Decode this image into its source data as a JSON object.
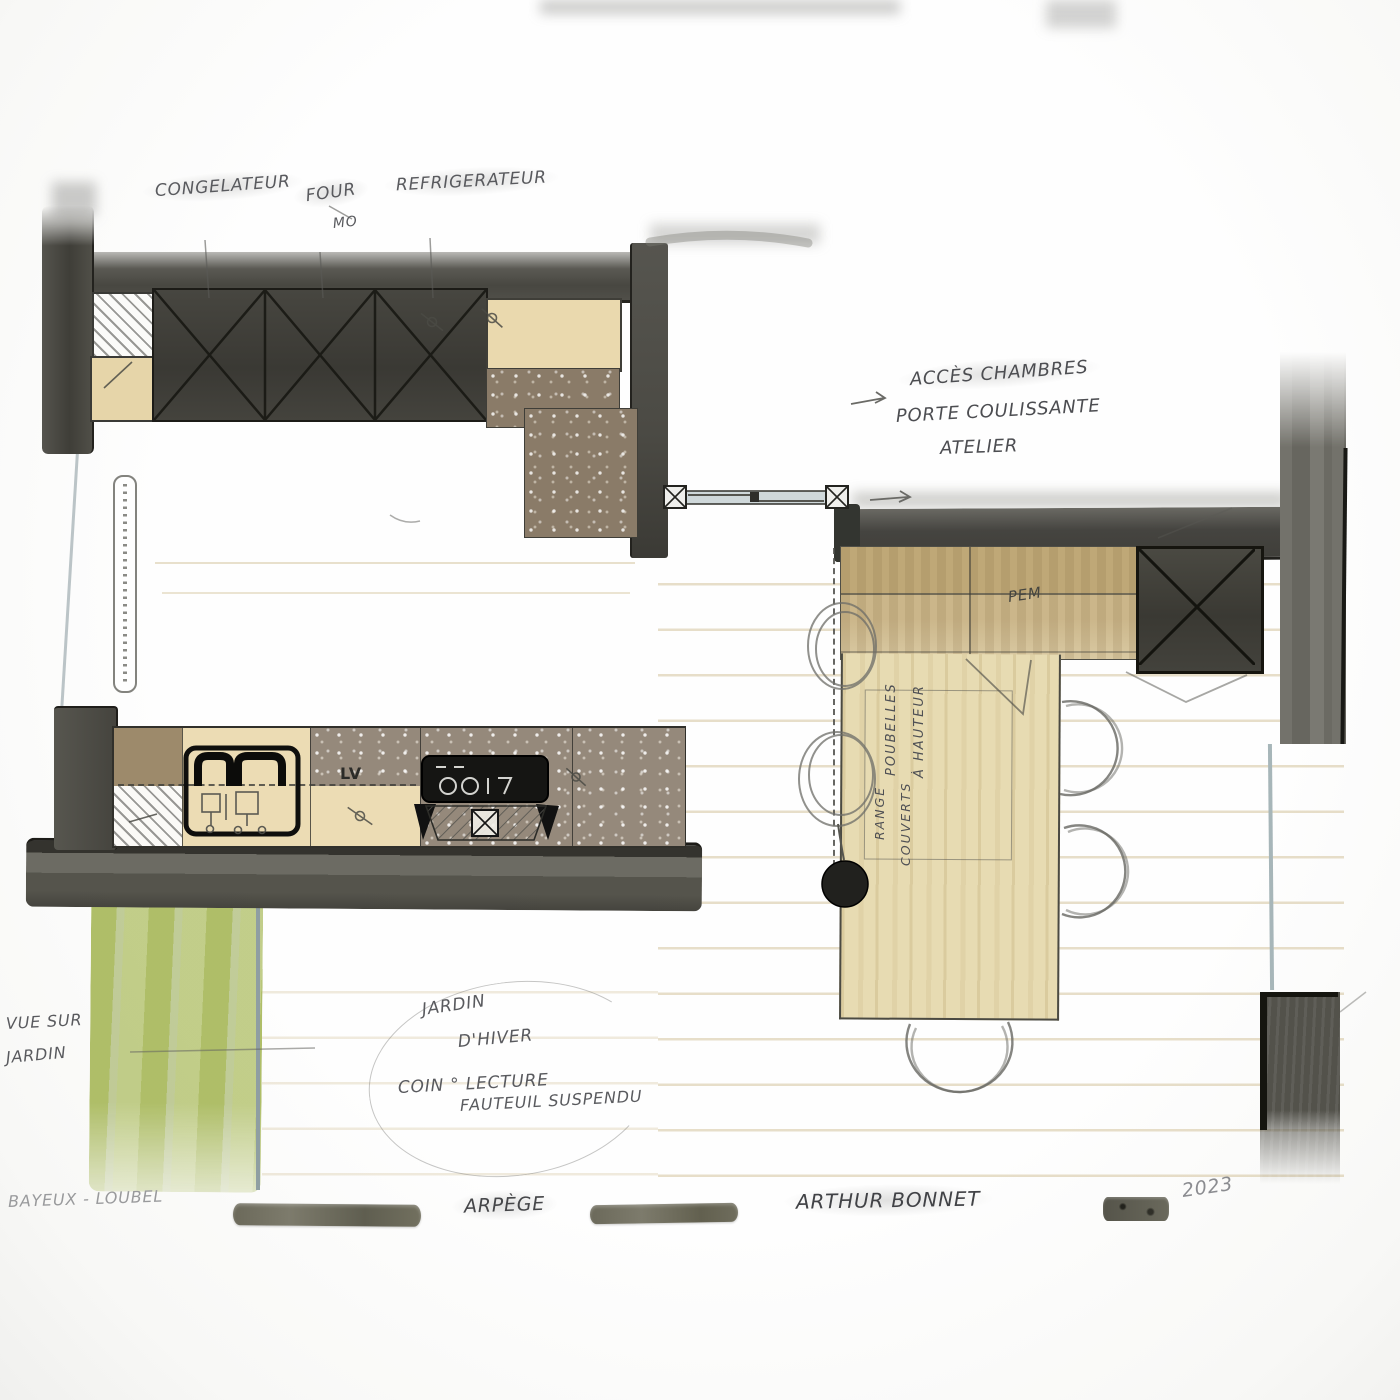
{
  "drawing": {
    "type": "hand-drawn kitchen floor plan sketch",
    "appliances": {
      "congelateur": "CONGELATEUR",
      "four": "FOUR",
      "micro_ondes": "MO",
      "refrigerateur": "REFRIGERATEUR",
      "lave_vaisselle": "LV",
      "petit_electromenager": "PEM"
    },
    "annotations": {
      "acces_chambres": "ACCÈS CHAMBRES",
      "porte_coulissante": "PORTE COULISSANTE",
      "atelier": "ATELIER",
      "poubelles": "POUBELLES",
      "a_hauteur": "À HAUTEUR",
      "range": "RANGE",
      "couverts": "COUVERTS",
      "vue_sur": "VUE SUR",
      "jardin": "JARDIN",
      "jardin_dhiver_line1": "JARDIN",
      "jardin_dhiver_line2": "D'HIVER",
      "coin_lecture": "COIN ° LECTURE",
      "fauteuil_suspendu": "FAUTEUIL SUSPENDU"
    },
    "title_block": {
      "client_location": "BAYEUX - LOUBEL",
      "model": "ARPÈGE",
      "brand": "ARTHUR BONNET",
      "year": "2023"
    },
    "colors": {
      "wall_dark": "#45443e",
      "cabinet_dark": "#3c3b35",
      "counter_beige": "#ead9ae",
      "counter_speckled_grey": "#95897b",
      "counter_speckled_brown": "#8a7b68",
      "counter_tan": "#c9b386",
      "table_wood": "#e7dbb2",
      "garden_green": "#a9ba62",
      "sliding_door_grey": "#cfd8da",
      "pencil_grey": "#55565a"
    }
  }
}
